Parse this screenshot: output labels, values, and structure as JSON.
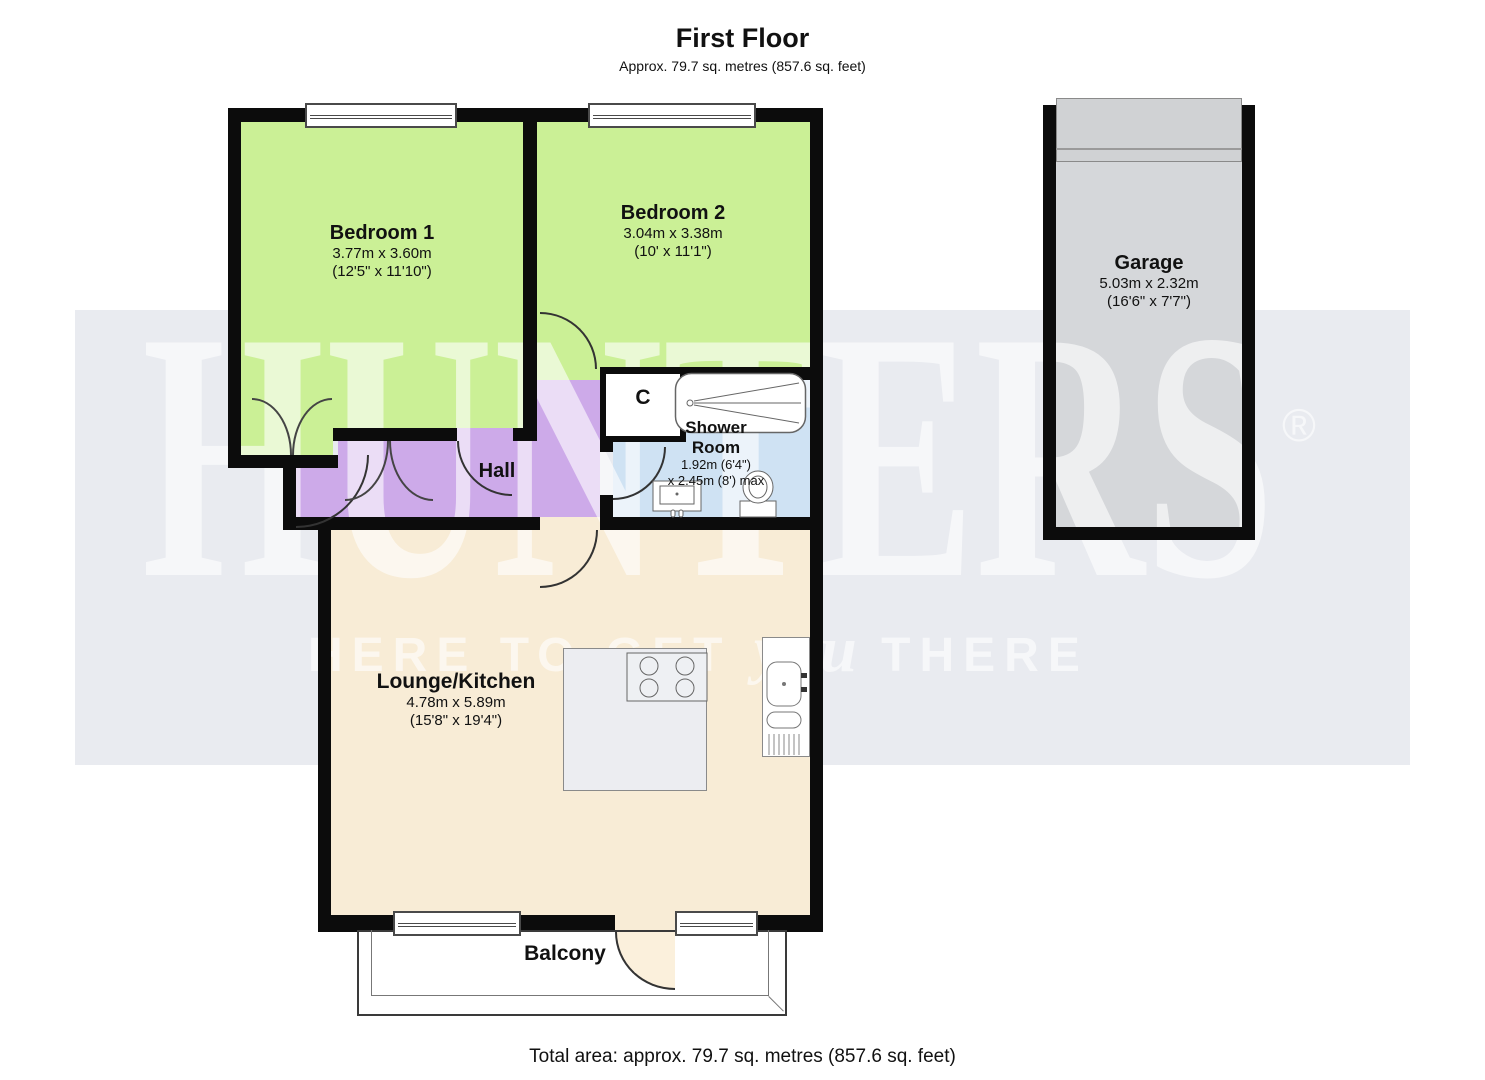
{
  "header": {
    "title": "First Floor",
    "subtitle": "Approx. 79.7 sq. metres (857.6 sq. feet)"
  },
  "watermark": {
    "brand": "HUNTERS",
    "registered": "®",
    "tagline_before": "HERE TO GET ",
    "tagline_script": "you",
    "tagline_after": " THERE"
  },
  "rooms": {
    "bedroom1": {
      "name": "Bedroom 1",
      "dims_metric": "3.77m x 3.60m",
      "dims_imperial": "(12'5\" x 11'10\")"
    },
    "bedroom2": {
      "name": "Bedroom 2",
      "dims_metric": "3.04m x 3.38m",
      "dims_imperial": "(10' x 11'1\")"
    },
    "garage": {
      "name": "Garage",
      "dims_metric": "5.03m x 2.32m",
      "dims_imperial": "(16'6\" x 7'7\")"
    },
    "shower_room": {
      "name_line1": "Shower",
      "name_line2": "Room",
      "dims_line1": "1.92m (6'4\")",
      "dims_line2": "x 2.45m (8') max"
    },
    "lounge": {
      "name": "Lounge/Kitchen",
      "dims_metric": "4.78m x 5.89m",
      "dims_imperial": "(15'8\" x 19'4\")"
    },
    "hall": {
      "name": "Hall"
    },
    "cupboard": {
      "name": "C"
    },
    "balcony": {
      "name": "Balcony"
    }
  },
  "footer": {
    "total_area": "Total area: approx. 79.7 sq. metres (857.6 sq. feet)"
  },
  "colors": {
    "bedroom_fill": "#cbf096",
    "hall_fill": "#cdaae9",
    "shower_fill": "#cfe2f3",
    "lounge_fill": "#f8ecd6",
    "garage_fill": "#d5d7da",
    "garage_door": "#d0d2d4",
    "wall": "#0c0c0c",
    "watermark_band": "#e9ebf0",
    "watermark_text": "#ffffff"
  }
}
